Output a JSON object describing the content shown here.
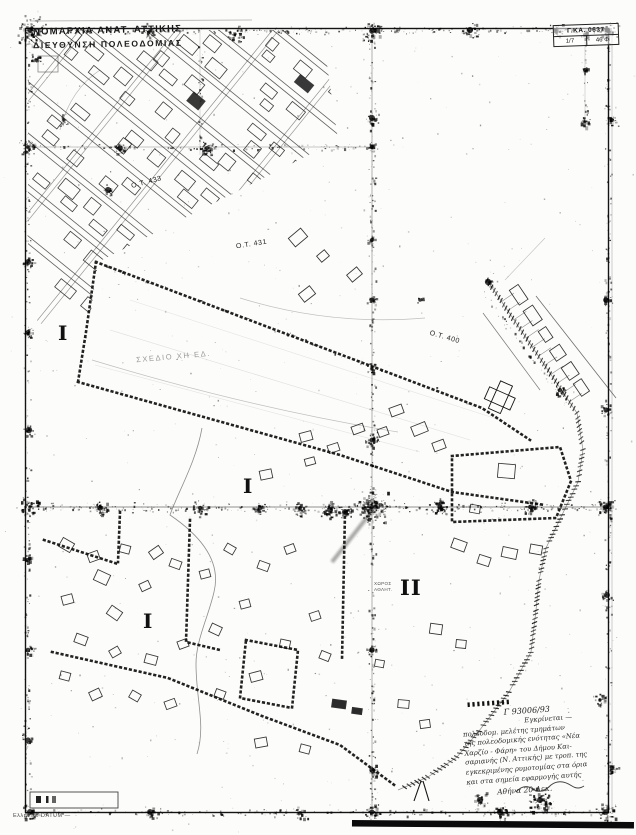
{
  "header": {
    "line1": "ΝΟΜΑΡΧΙΑ ΑΝΑΤ. ΑΤΤΙΚΗΣ",
    "line2": "ΔΙΕΥΘΥΝΣΗ ΠΟΛΕΟΔΟΜΙΑΣ"
  },
  "stamp": {
    "row1": "Γ.ΚΑ. 0637",
    "row2a": "1/7",
    "row2b": "46 Φ"
  },
  "blocks": {
    "ot433": "Ο.Τ. 433",
    "ot431": "Ο.Τ. 431",
    "ot400": "Ο.Τ. 400"
  },
  "faint_label": "ΣΧΕΔΙΟ ΧΗ ΕΔ.",
  "area_label": {
    "line1": "ΧΩΡΟΣ",
    "line2": "ΑΘΛΗΤ."
  },
  "zones": {
    "zone_a": "I",
    "zone_b": "I",
    "zone_c": "I",
    "zone_d": "II"
  },
  "approval": {
    "tick_row": "▮▮▮▮▮▮▮▮▮",
    "ref": "Γ 93006/93",
    "lines": [
      "Εγκρίνεται —",
      "πολεοδομ. μελέτης τμημάτων",
      "της πολεοδομικής ενότητας «Νέα",
      "Χαρζίο - Φάρη» του Δήμου Και-",
      "σαριανής (Ν. Αττικής) με τροπ. της",
      "εγκεκριμένης ρυμοτομίας στα όρια",
      "και στα σημεία εφαρμογής αυτής"
    ],
    "closing": "Αθήνα 20 Δεκ."
  },
  "footer": {
    "datum": "Ελληνικό DATUM  —"
  },
  "colors": {
    "ink": "#161616",
    "paper": "#fcfcfa",
    "faint": "#9a9a9a"
  }
}
